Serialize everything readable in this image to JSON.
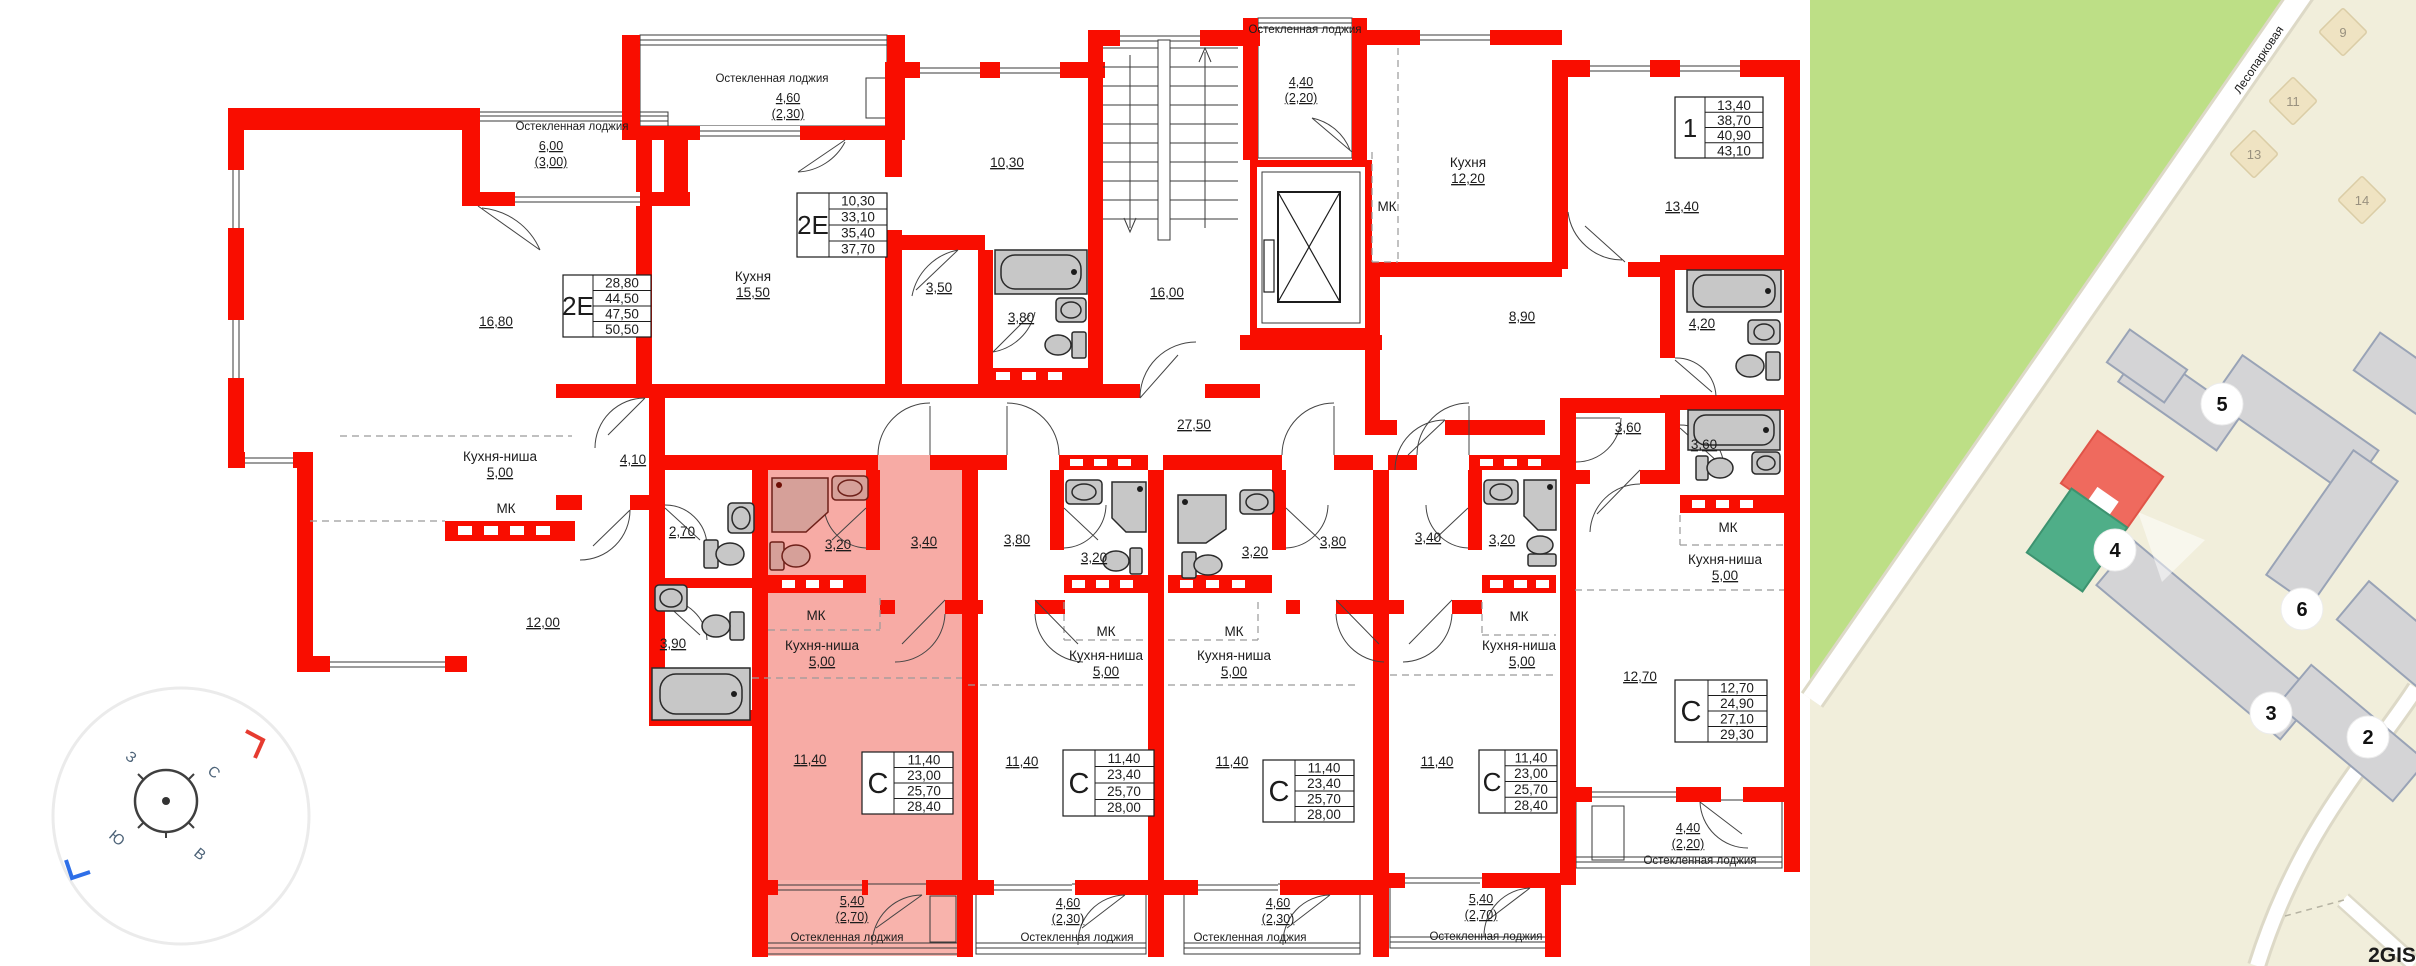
{
  "plan": {
    "loggia_label": "Остекленная лоджия",
    "kitchen_label": "Кухня",
    "kitchen_niche_label": "Кухня-ниша",
    "mk_label": "МК",
    "types": {
      "two_euro": "2Е",
      "one_room": "1",
      "studio": "С"
    },
    "rooms": {
      "r1680": "16,80",
      "r1550": "15,50",
      "r1030": "10,30",
      "r350": "3,50",
      "r380": "3,80",
      "r1600": "16,00",
      "r2750": "27,50",
      "r1220": "12,20",
      "r1340": "13,40",
      "r890": "8,90",
      "r420": "4,20",
      "r410": "4,10",
      "r270": "2,70",
      "r1200": "12,00",
      "r390": "3,90",
      "r320": "3,20",
      "r340": "3,40",
      "r1140": "11,40",
      "r360": "3,60",
      "r1270": "12,70",
      "niche500": "5,00"
    },
    "lodges": {
      "l600": "6,00",
      "l300": "(3,00)",
      "l460": "4,60",
      "l230": "(2,30)",
      "l440": "4,40",
      "l220": "(2,20)",
      "l540": "5,40",
      "l270": "(2,70)"
    },
    "tables": {
      "left_2e": {
        "values": [
          "28,80",
          "44,50",
          "47,50",
          "50,50"
        ]
      },
      "mid_2e": {
        "values": [
          "10,30",
          "33,10",
          "35,40",
          "37,70"
        ]
      },
      "one_room": {
        "values": [
          "13,40",
          "38,70",
          "40,90",
          "43,10"
        ]
      },
      "studio_a": {
        "values": [
          "11,40",
          "23,00",
          "25,70",
          "28,40"
        ]
      },
      "studio_b": {
        "values": [
          "11,40",
          "23,40",
          "25,70",
          "28,00"
        ]
      },
      "studio_c": {
        "values": [
          "11,40",
          "23,40",
          "25,70",
          "28,00"
        ]
      },
      "studio_d": {
        "values": [
          "11,40",
          "23,00",
          "25,70",
          "28,40"
        ]
      },
      "studio_e": {
        "values": [
          "12,70",
          "24,90",
          "27,10",
          "29,30"
        ]
      }
    }
  },
  "map": {
    "street": "Лесопарковая",
    "badges": {
      "b5": "5",
      "b4": "4",
      "b6": "6",
      "b3": "3",
      "b2": "2"
    },
    "small_buildings": {
      "s9": "9",
      "s11": "11",
      "s13": "13",
      "s14": "14"
    },
    "watermark": "2GIS"
  },
  "compass": {
    "n": "С",
    "s": "Ю",
    "e": "В",
    "w": "З"
  },
  "colors": {
    "wall": "#f90d00",
    "highlight": "#f7aba5",
    "map_green": "#bddf86",
    "map_bg": "#f1eedb",
    "selected_red": "#ef6a5e",
    "selected_green": "#4fae88"
  }
}
